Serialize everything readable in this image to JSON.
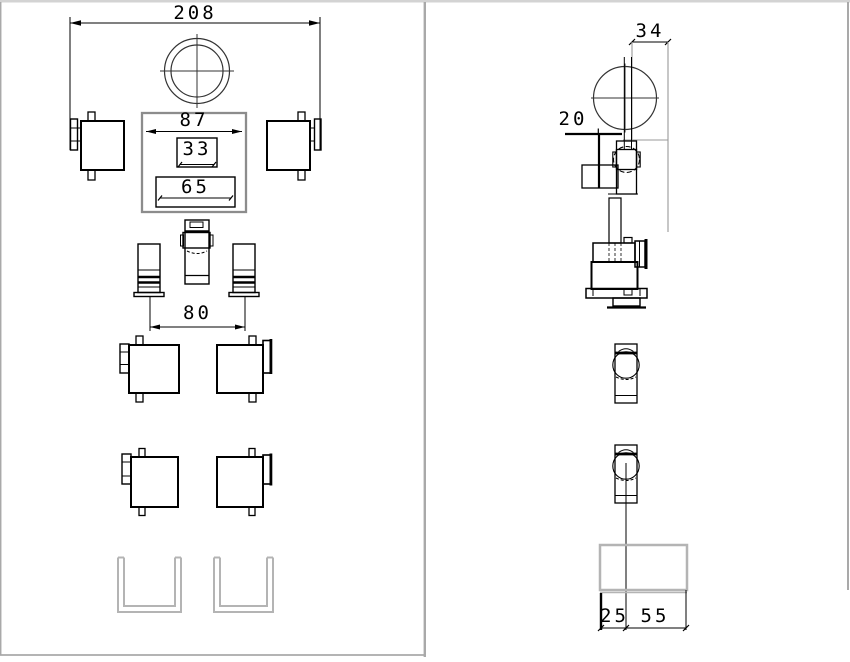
{
  "drawing": {
    "type": "engineering-two-view-drawing",
    "colors": {
      "background": "#ffffff",
      "line": "#000000",
      "construction_gray": "#999999",
      "channel_gray": "#b4b4b4",
      "frame_gray": "#a9a9a9",
      "frame_top_gray": "#d3d3d3"
    },
    "front_view": {
      "name": "front-view",
      "dims": {
        "overall_width": "208",
        "plate_width": "87",
        "slot_width": "33",
        "opening_width": "65",
        "column_span": "80"
      }
    },
    "side_view": {
      "name": "side-view",
      "dims": {
        "head_width": "34",
        "head_offset": "20",
        "base_front": "25",
        "base_rear": "55"
      }
    }
  }
}
